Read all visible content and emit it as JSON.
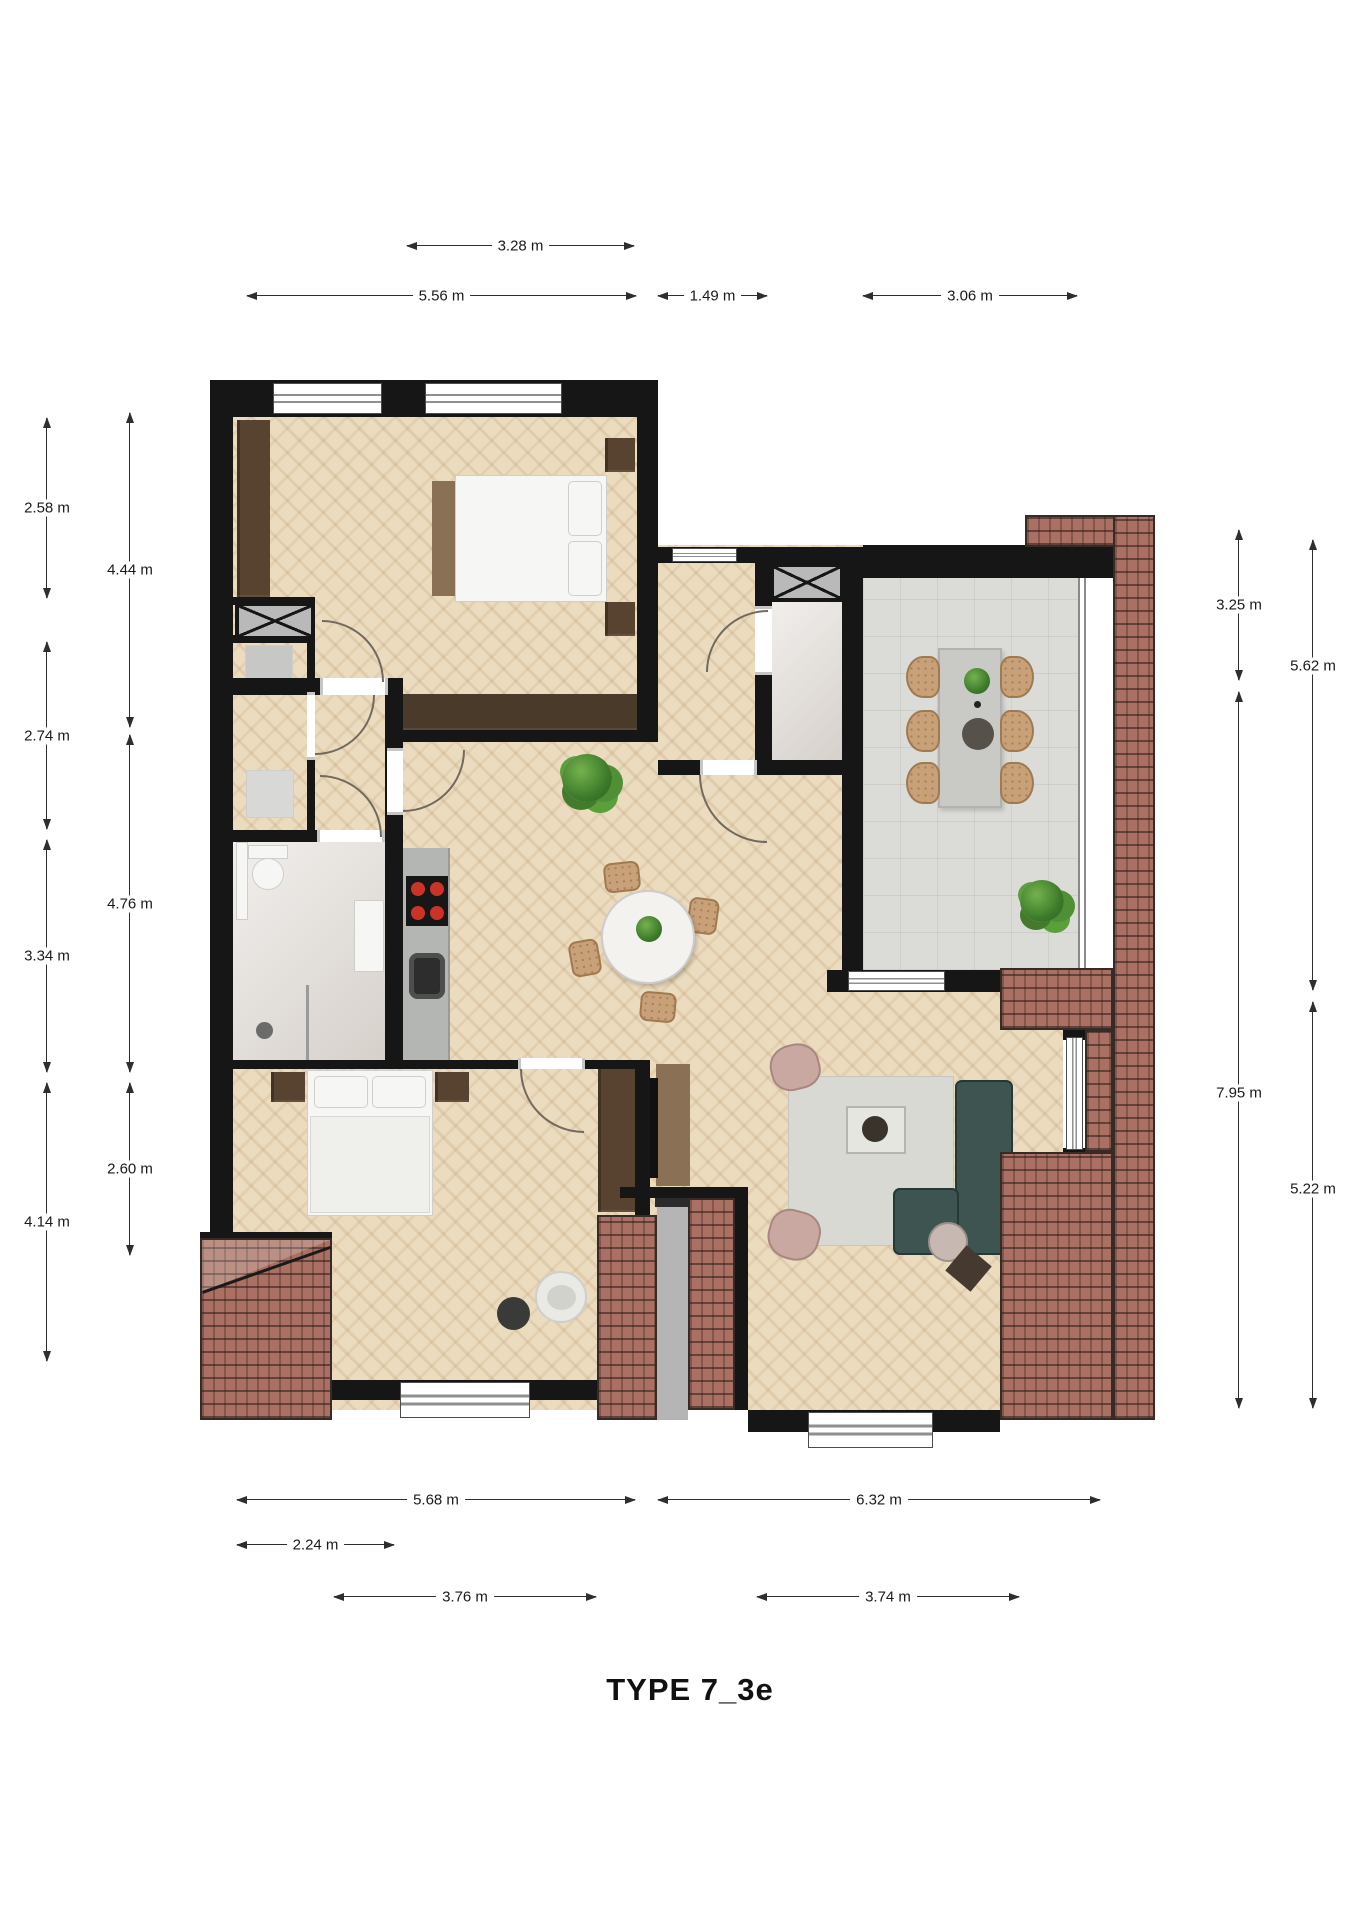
{
  "title": "TYPE 7_3e",
  "dims": {
    "top": [
      "3.28 m",
      "5.56 m",
      "1.49 m",
      "3.06 m"
    ],
    "left_outer": [
      "2.58 m",
      "2.74 m",
      "3.34 m",
      "4.14 m"
    ],
    "left_inner": [
      "4.44 m",
      "4.76 m",
      "2.60 m"
    ],
    "right_inner": [
      "3.25 m",
      "7.95 m"
    ],
    "right_outer": [
      "5.62 m",
      "5.22 m"
    ],
    "bottom": [
      "5.68 m",
      "6.32 m",
      "2.24 m",
      "3.76 m",
      "3.74 m"
    ]
  },
  "colors": {
    "wall": "#161616",
    "parquet": "#ecdcbf",
    "balcony_tile": "#dbdcd8",
    "bath_floor": "#e3ded9",
    "brick_roof": "#aa7063",
    "sofa": "#3d5450",
    "wood_dark": "#57432f",
    "chair_tan": "#c9a179",
    "plant_green": "#3c7a2a"
  },
  "features": [
    "double-bed",
    "single-bed",
    "wardrobe",
    "dresser",
    "nightstand",
    "toilet",
    "shower",
    "sink",
    "washing-machine",
    "installation-shaft",
    "kitchen-counter",
    "cooktop",
    "kitchen-sink",
    "round-dining-table",
    "dining-chair",
    "potted-plant",
    "balcony-table",
    "balcony-chair",
    "corner-sofa",
    "rug",
    "coffee-table",
    "armchair",
    "tv-cabinet",
    "side-table",
    "dog-bed",
    "food-bowl",
    "front-door",
    "window",
    "door-swing",
    "brick-roof"
  ]
}
